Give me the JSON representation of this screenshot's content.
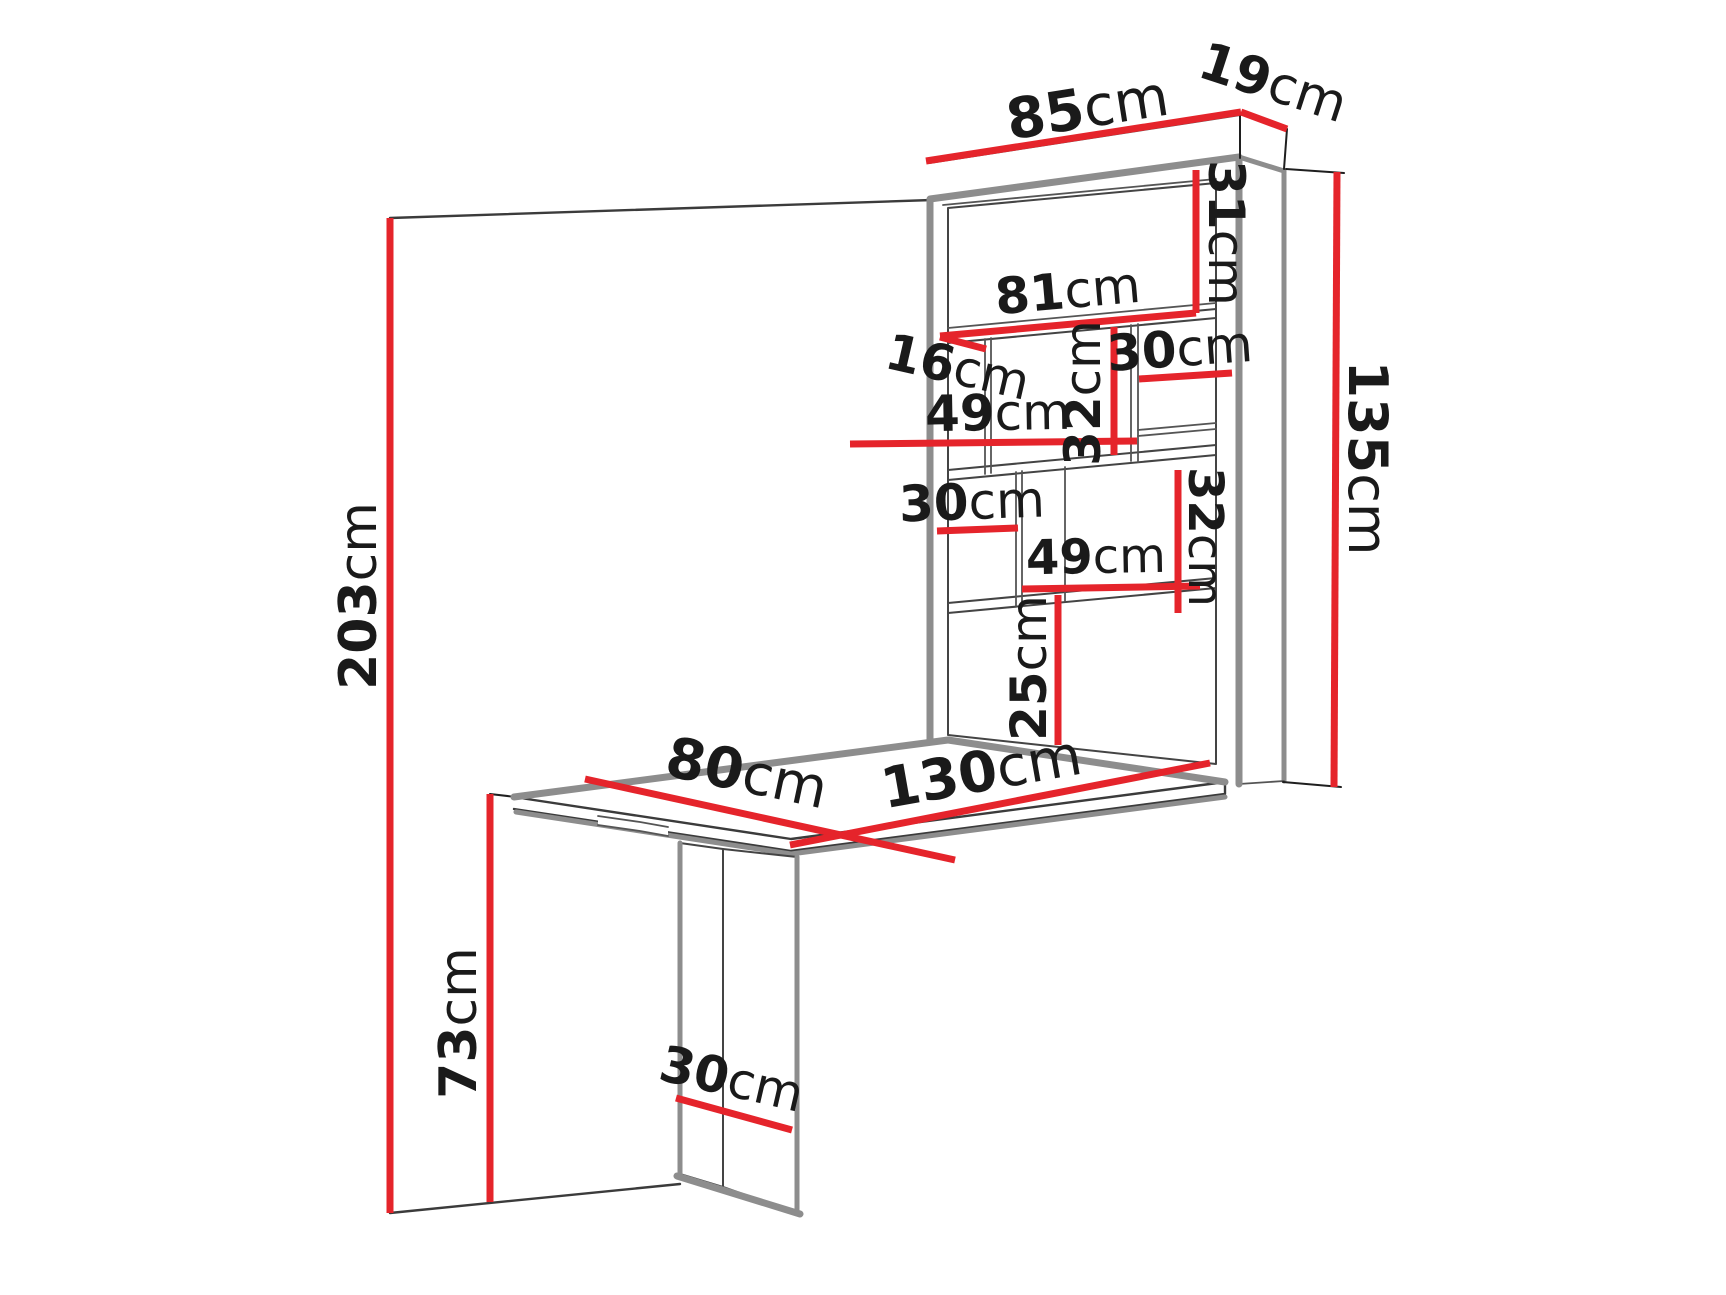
{
  "diagram": {
    "type": "furniture-dimension-diagram",
    "subject": "wall-mounted fold-out desk with shelf cabinet",
    "unit": "cm",
    "colors": {
      "dimension_line": "#e5242b",
      "label_text": "#1a1a1a",
      "outline_thick": "#8d8d8d",
      "outline_thin": "#3b3b3b",
      "background": "#ffffff"
    },
    "label_font_size_default": 50,
    "dimension_line_width": 7,
    "dimensions": [
      {
        "id": "cabinet-width",
        "value": "85",
        "unit": "cm",
        "line": {
          "x1": 926,
          "y1": 161,
          "x2": 1241,
          "y2": 112
        },
        "label": {
          "x": 1088,
          "y": 112,
          "rotate": -9,
          "size": 56
        }
      },
      {
        "id": "cabinet-depth",
        "value": "19",
        "unit": "cm",
        "line": {
          "x1": 1241,
          "y1": 112,
          "x2": 1287,
          "y2": 129
        },
        "label": {
          "x": 1272,
          "y": 86,
          "rotate": 18,
          "size": 52
        }
      },
      {
        "id": "top-compartment-height",
        "value": "31",
        "unit": "cm",
        "line": {
          "x1": 1196,
          "y1": 170,
          "x2": 1196,
          "y2": 313
        },
        "label": {
          "x": 1223,
          "y": 233,
          "rotate": 90,
          "size": 50
        }
      },
      {
        "id": "shelf-width",
        "value": "81",
        "unit": "cm",
        "line": {
          "x1": 940,
          "y1": 336,
          "x2": 1196,
          "y2": 313
        },
        "label": {
          "x": 1068,
          "y": 294,
          "rotate": -5,
          "size": 50
        }
      },
      {
        "id": "shelf-depth",
        "value": "16",
        "unit": "cm",
        "line": {
          "x1": 940,
          "y1": 337,
          "x2": 986,
          "y2": 349
        },
        "label": {
          "x": 957,
          "y": 370,
          "rotate": 13,
          "size": 50
        }
      },
      {
        "id": "middle-section-width",
        "value": "49",
        "unit": "cm",
        "line": {
          "x1": 850,
          "y1": 444,
          "x2": 1137,
          "y2": 441
        },
        "label": {
          "x": 998,
          "y": 416,
          "rotate": -1,
          "size": 50
        }
      },
      {
        "id": "middle-section-height",
        "value": "32",
        "unit": "cm",
        "line": {
          "x1": 1114,
          "y1": 327,
          "x2": 1114,
          "y2": 455
        },
        "label": {
          "x": 1086,
          "y": 393,
          "rotate": -90,
          "size": 50
        }
      },
      {
        "id": "upper-right-cubby-width",
        "value": "30",
        "unit": "cm",
        "line": {
          "x1": 1139,
          "y1": 379,
          "x2": 1232,
          "y2": 373
        },
        "label": {
          "x": 1180,
          "y": 352,
          "rotate": -4,
          "size": 50
        }
      },
      {
        "id": "lower-left-cubby-width",
        "value": "30",
        "unit": "cm",
        "line": {
          "x1": 937,
          "y1": 531,
          "x2": 1018,
          "y2": 528
        },
        "label": {
          "x": 972,
          "y": 505,
          "rotate": -2,
          "size": 50
        }
      },
      {
        "id": "lower-right-section-width",
        "value": "49",
        "unit": "cm",
        "line": {
          "x1": 1022,
          "y1": 589,
          "x2": 1200,
          "y2": 586
        },
        "label": {
          "x": 1096,
          "y": 560,
          "rotate": -1,
          "size": 48
        }
      },
      {
        "id": "lower-right-section-height",
        "value": "32",
        "unit": "cm",
        "line": {
          "x1": 1178,
          "y1": 470,
          "x2": 1178,
          "y2": 613
        },
        "label": {
          "x": 1202,
          "y": 537,
          "rotate": 90,
          "size": 48
        }
      },
      {
        "id": "bottom-compartment-height",
        "value": "25",
        "unit": "cm",
        "line": {
          "x1": 1058,
          "y1": 595,
          "x2": 1058,
          "y2": 745
        },
        "label": {
          "x": 1032,
          "y": 668,
          "rotate": -90,
          "size": 50
        }
      },
      {
        "id": "cabinet-height",
        "value": "135",
        "unit": "cm",
        "line": {
          "x1": 1337,
          "y1": 172,
          "x2": 1334,
          "y2": 787
        },
        "label": {
          "x": 1364,
          "y": 458,
          "rotate": 90,
          "size": 54
        }
      },
      {
        "id": "total-height",
        "value": "203",
        "unit": "cm",
        "line": {
          "x1": 390,
          "y1": 218,
          "x2": 390,
          "y2": 1213
        },
        "label": {
          "x": 362,
          "y": 596,
          "rotate": -90,
          "size": 52
        }
      },
      {
        "id": "desk-width",
        "value": "80",
        "unit": "cm",
        "line": {
          "x1": 585,
          "y1": 779,
          "x2": 955,
          "y2": 860
        },
        "label": {
          "x": 746,
          "y": 777,
          "rotate": 12,
          "size": 56
        }
      },
      {
        "id": "desk-length",
        "value": "130",
        "unit": "cm",
        "line": {
          "x1": 790,
          "y1": 845,
          "x2": 1210,
          "y2": 763
        },
        "label": {
          "x": 982,
          "y": 776,
          "rotate": -10,
          "size": 56
        }
      },
      {
        "id": "desk-height",
        "value": "73",
        "unit": "cm",
        "line": {
          "x1": 490,
          "y1": 794,
          "x2": 490,
          "y2": 1202
        },
        "label": {
          "x": 462,
          "y": 1023,
          "rotate": -90,
          "size": 52
        }
      },
      {
        "id": "leg-depth",
        "value": "30",
        "unit": "cm",
        "line": {
          "x1": 676,
          "y1": 1098,
          "x2": 792,
          "y2": 1130
        },
        "label": {
          "x": 731,
          "y": 1082,
          "rotate": 13,
          "size": 50
        }
      }
    ]
  }
}
